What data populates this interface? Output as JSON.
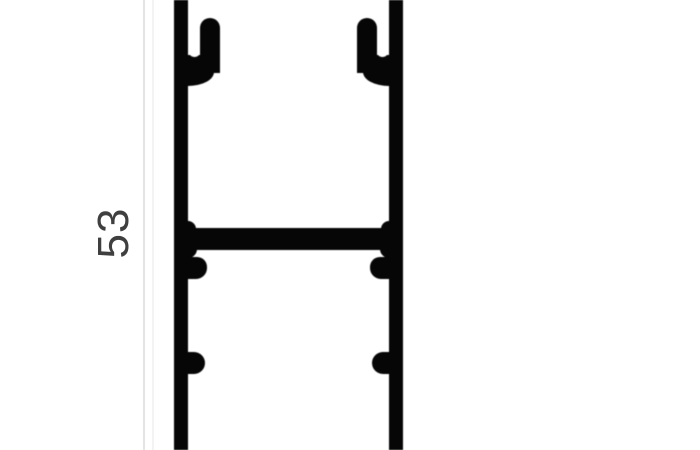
{
  "drawing": {
    "type": "aluminium-profile-cross-section",
    "dimension_label": "53",
    "colors": {
      "profile": "#060606",
      "background": "#ffffff",
      "dimension_line": "#e4e4e4",
      "dimension_text": "#3f3f3f"
    }
  }
}
